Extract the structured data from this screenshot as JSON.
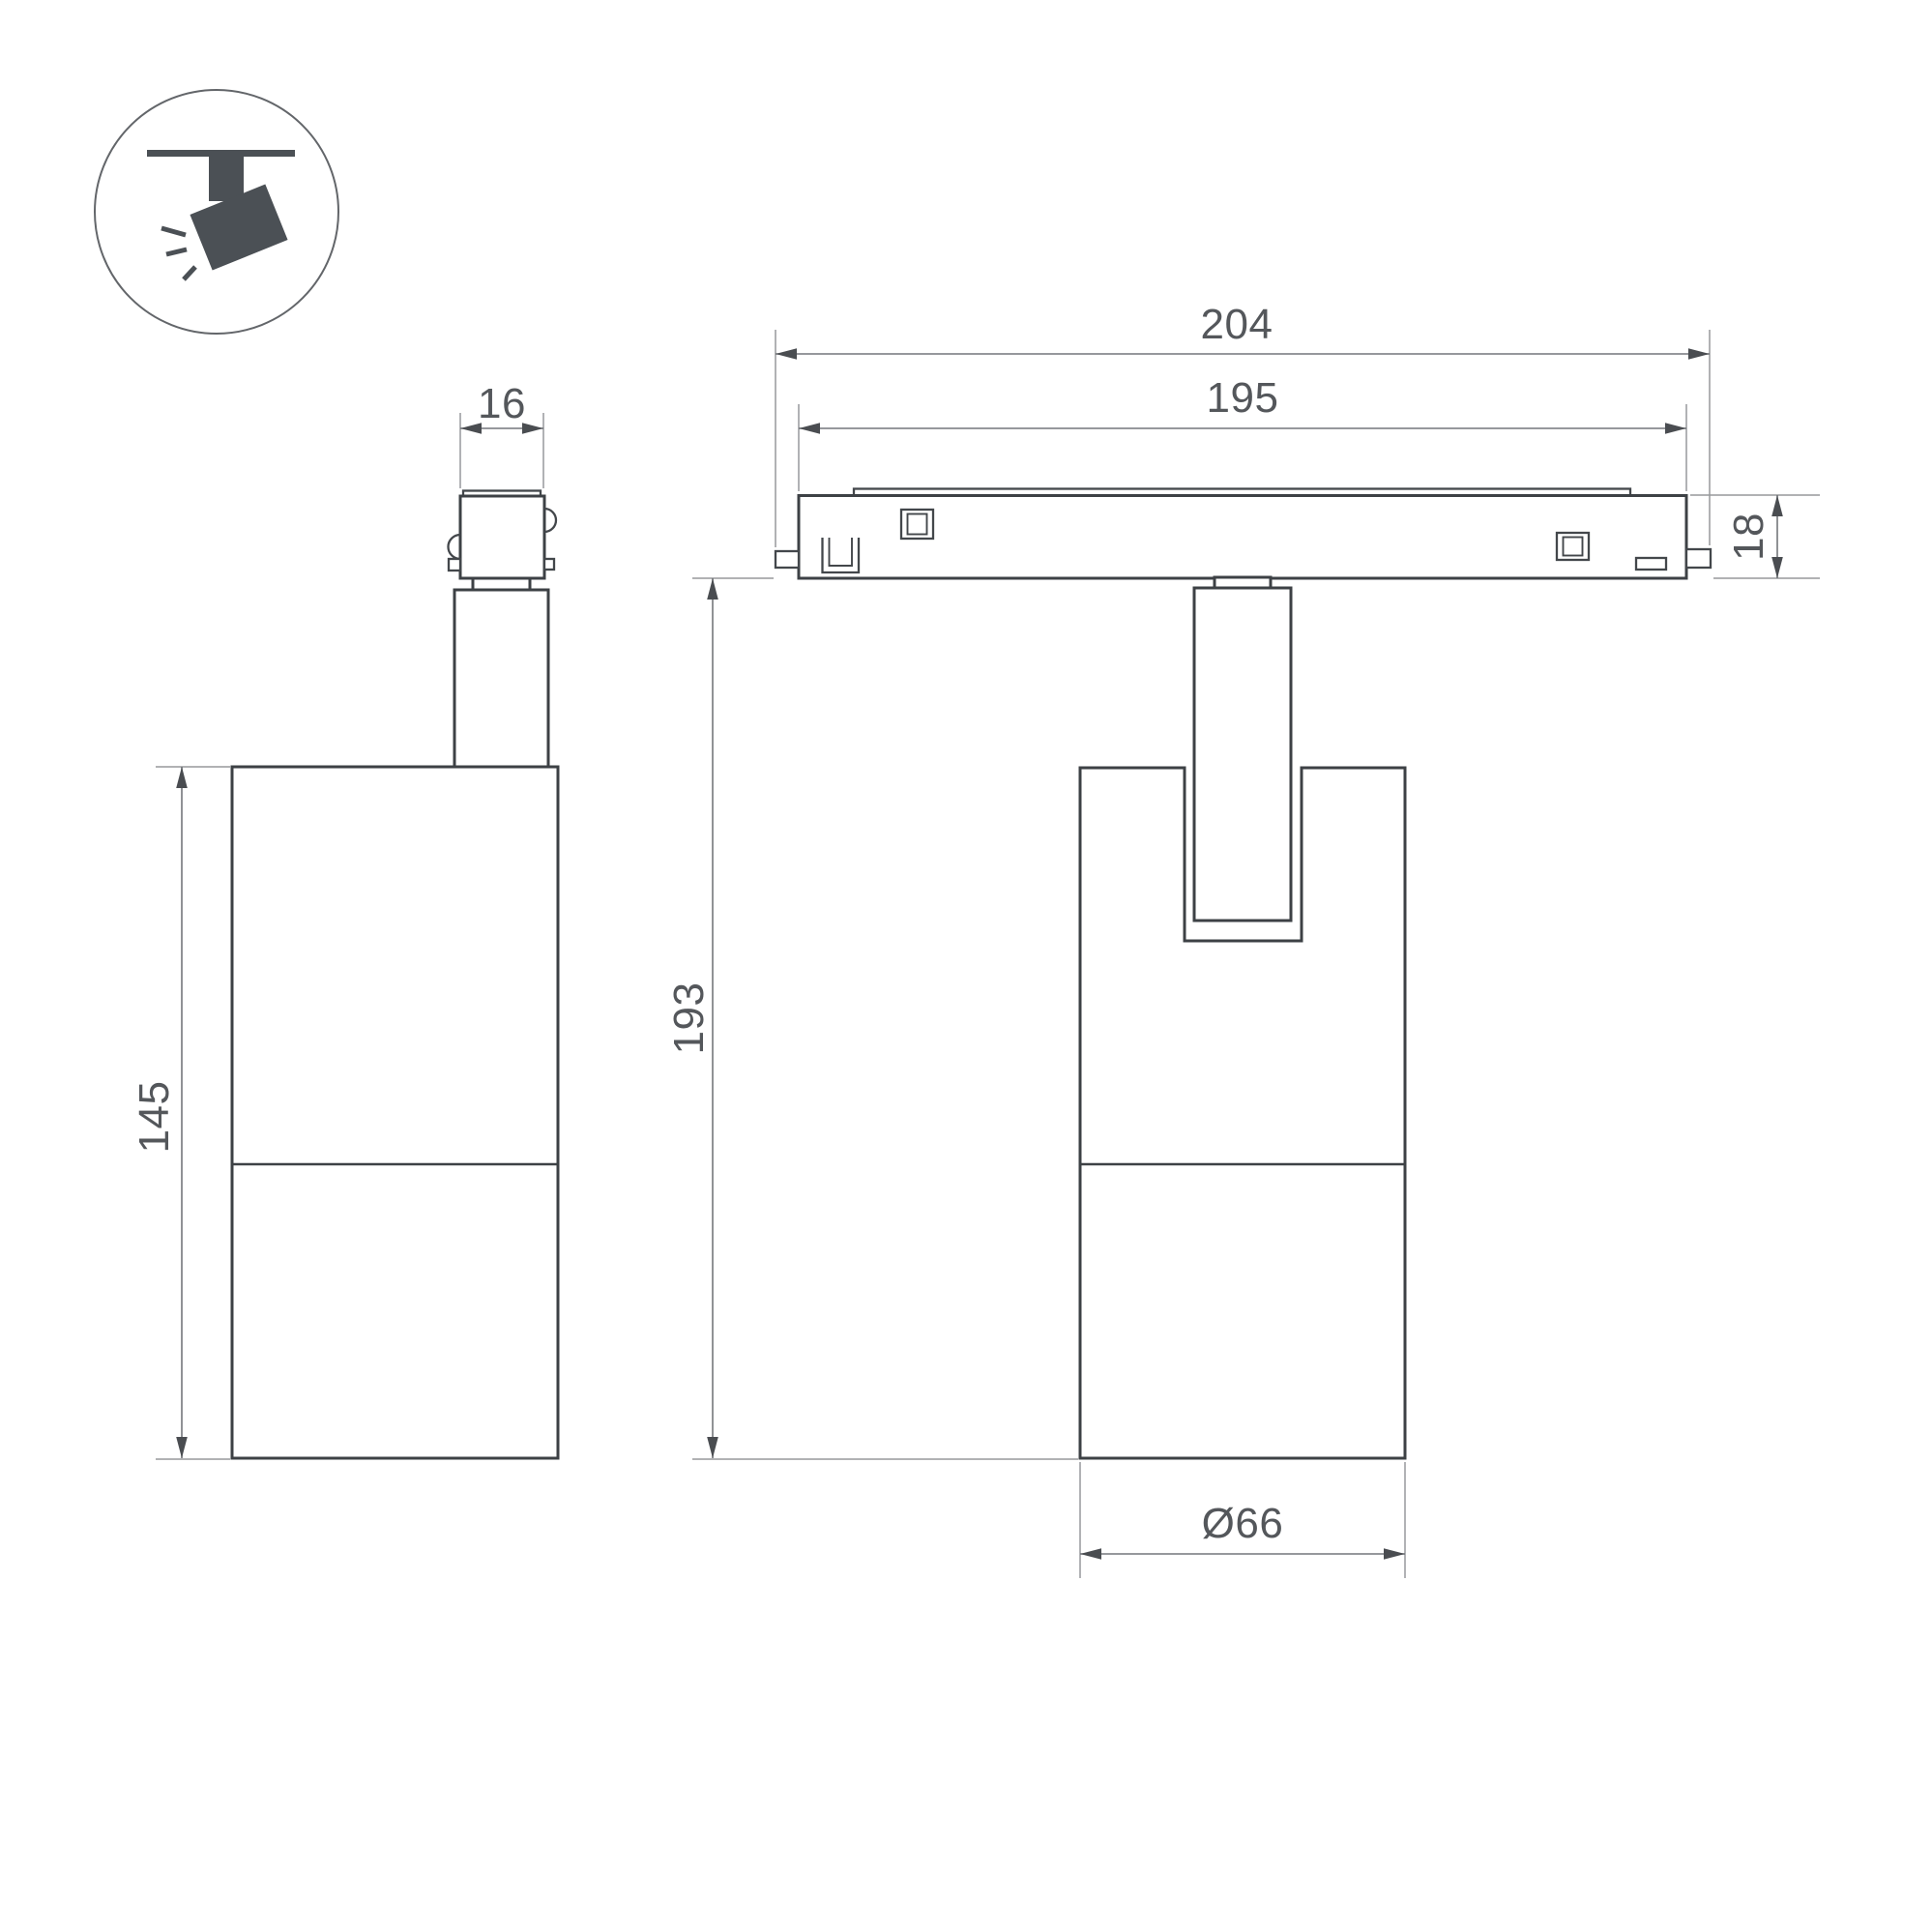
{
  "drawing": {
    "icon": {
      "name": "ceiling-track-spotlight-pictogram"
    },
    "dimensions": {
      "track_outer_length": "204",
      "track_body_length": "195",
      "adapter_width": "16",
      "track_height": "18",
      "total_height": "193",
      "body_height": "145",
      "body_diameter": "Ø66"
    },
    "colors": {
      "background": "#ffffff",
      "outline": "#3d4145",
      "dimension_line": "#74777b",
      "extension_line": "#97999c",
      "arrow": "#4a4d51",
      "label_text": "#54575b",
      "icon_fill": "#4b5055"
    }
  }
}
